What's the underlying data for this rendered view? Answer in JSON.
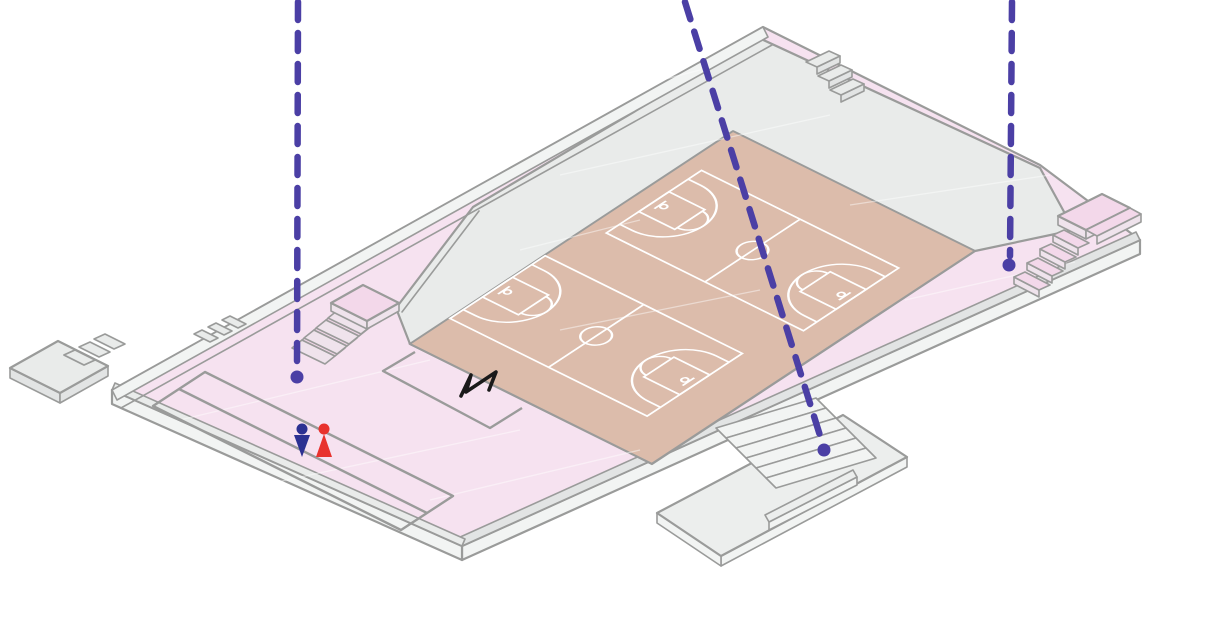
{
  "scene": {
    "type": "isometric-architectural-diagram",
    "subject": "Elevated plaza deck with two basketball courts, six staircases, lower terrace platform, and three dashed vertical drop lines marking level changes",
    "background": "#ffffff"
  },
  "colors": {
    "floor_pink": "#f6e2f0",
    "pink_step": "#f3d8ea",
    "pink_side": "#efe3ec",
    "deck": "#e9ebea",
    "deck_dark": "#e2e4e4",
    "side_face": "#f2f4f3",
    "platform": "#eceeed",
    "court_tan": "#dcbcab",
    "court_line": "#ffffff",
    "outline": "#9a9b9a",
    "indigo": "#4b3fa5",
    "marker_blue": "#2c3192",
    "marker_red": "#e8322d",
    "ink": "#1a1a1a"
  },
  "annotations": {
    "droplines": [
      {
        "id": "dropline-left",
        "path": "M298,2 L297,368",
        "dot": "translate(297,377)"
      },
      {
        "id": "dropline-middle",
        "path": "M685,2 L822,442",
        "dot": "translate(824,450)"
      },
      {
        "id": "dropline-right",
        "path": "M1012,2 L1010,256",
        "dot": "translate(1009,265)"
      }
    ],
    "markers": {
      "blue_person": {
        "transform": "translate(302,430)",
        "color": "#2c3192"
      },
      "red_person": {
        "transform": "translate(324,431)",
        "color": "#e8322d"
      },
      "scribble": {
        "path": "M461,396 L471,375 L466,392 L496,372 L489,390",
        "color": "#1a1a1a"
      }
    }
  },
  "features": {
    "basketball_court_count": 2,
    "staircase_count": 6,
    "dropline_count": 3,
    "person_marker_count": 2
  }
}
